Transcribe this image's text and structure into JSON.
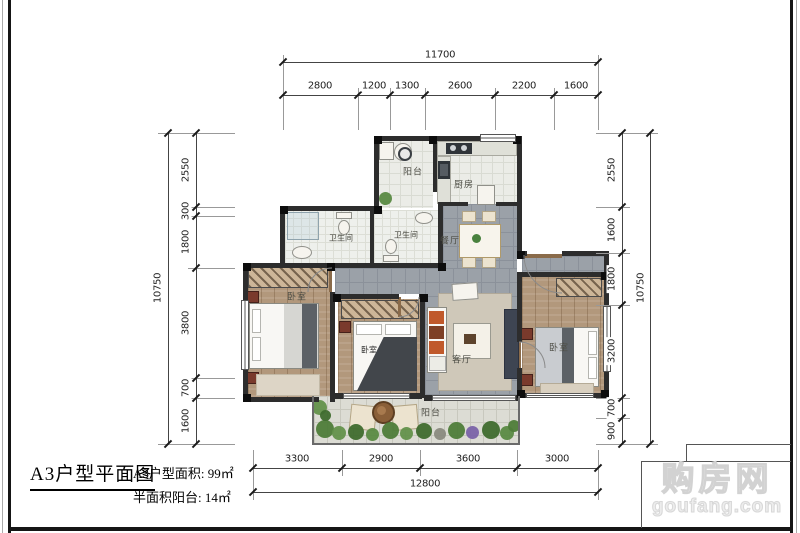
{
  "title_block": {
    "title": "A3户型平面图",
    "area_label_1": "A3户型面积: 99㎡",
    "area_label_2": "半面积阳台: 14㎡"
  },
  "watermark": {
    "brand": "购房网",
    "domain": "goufang.com"
  },
  "rooms": {
    "balcony_top": "阳台",
    "kitchen": "厨房",
    "bath_left": "卫生间",
    "bath_right": "卫生间",
    "dining": "餐厅",
    "bedroom_left": "卧室",
    "bedroom_mid": "卧室",
    "living": "客厅",
    "bedroom_right": "卧室",
    "balcony_bottom": "阳台"
  },
  "dimensions": {
    "top": {
      "total": "11700",
      "segments": [
        "2800",
        "1200",
        "1300",
        "2600",
        "2200",
        "1600"
      ]
    },
    "bottom": {
      "total": "12800",
      "segments": [
        "3300",
        "2900",
        "3600",
        "3000"
      ]
    },
    "left": {
      "total": "10750",
      "segments": [
        "2550",
        "300",
        "1800",
        "3800",
        "700",
        "1600"
      ]
    },
    "right": {
      "total": "10750",
      "segments": [
        "2550",
        "1600",
        "1800",
        "3200",
        "700",
        "900"
      ]
    }
  },
  "colors": {
    "wall": "#2d2d2d",
    "wood_floor": "#b2987c",
    "tile_gray": "#9ba1a8",
    "tile_light": "#ebece7",
    "plant_green": "#4e7c39",
    "accent_furniture": "#7a3a2c"
  }
}
